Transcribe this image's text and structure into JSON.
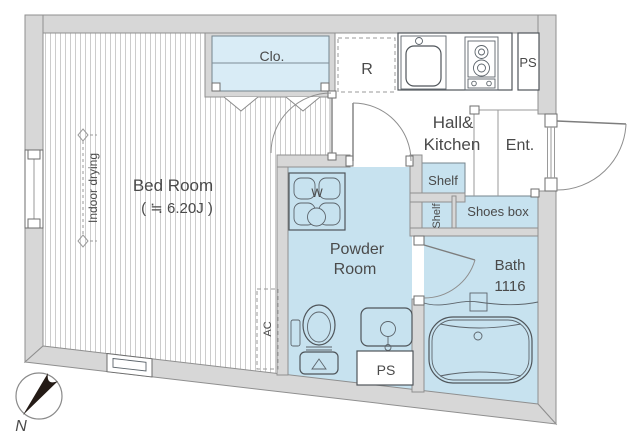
{
  "colors": {
    "wall_gray": "#d7d7d7",
    "room_blue": "#c7e2ef",
    "closet_blue": "#d9ecf6",
    "stripe_gray": "#cccccc",
    "line_dark": "#4f555a",
    "text_gray": "#4a4a4a",
    "needle_black": "#241b16"
  },
  "plan": {
    "bedroom": {
      "name": "Bed Room",
      "size": "( ≒ 6.20J )",
      "indoor_drying": "Indoor drying",
      "ac_label": "AC",
      "closet_label": "Clo."
    },
    "hall_kitchen": {
      "name_line1": "Hall&",
      "name_line2": "Kitchen",
      "refrigerator_label": "R",
      "pipe_space_top": "PS"
    },
    "entrance": {
      "name": "Ent.",
      "shoes_box": "Shoes box",
      "shelf_upper": "Shelf",
      "shelf_lower": "Shelf"
    },
    "powder_room": {
      "name_line1": "Powder",
      "name_line2": "Room",
      "washer_label": "W",
      "pipe_space_bottom": "PS"
    },
    "bath": {
      "name": "Bath",
      "size": "1116"
    },
    "compass": {
      "north_label": "N"
    }
  }
}
